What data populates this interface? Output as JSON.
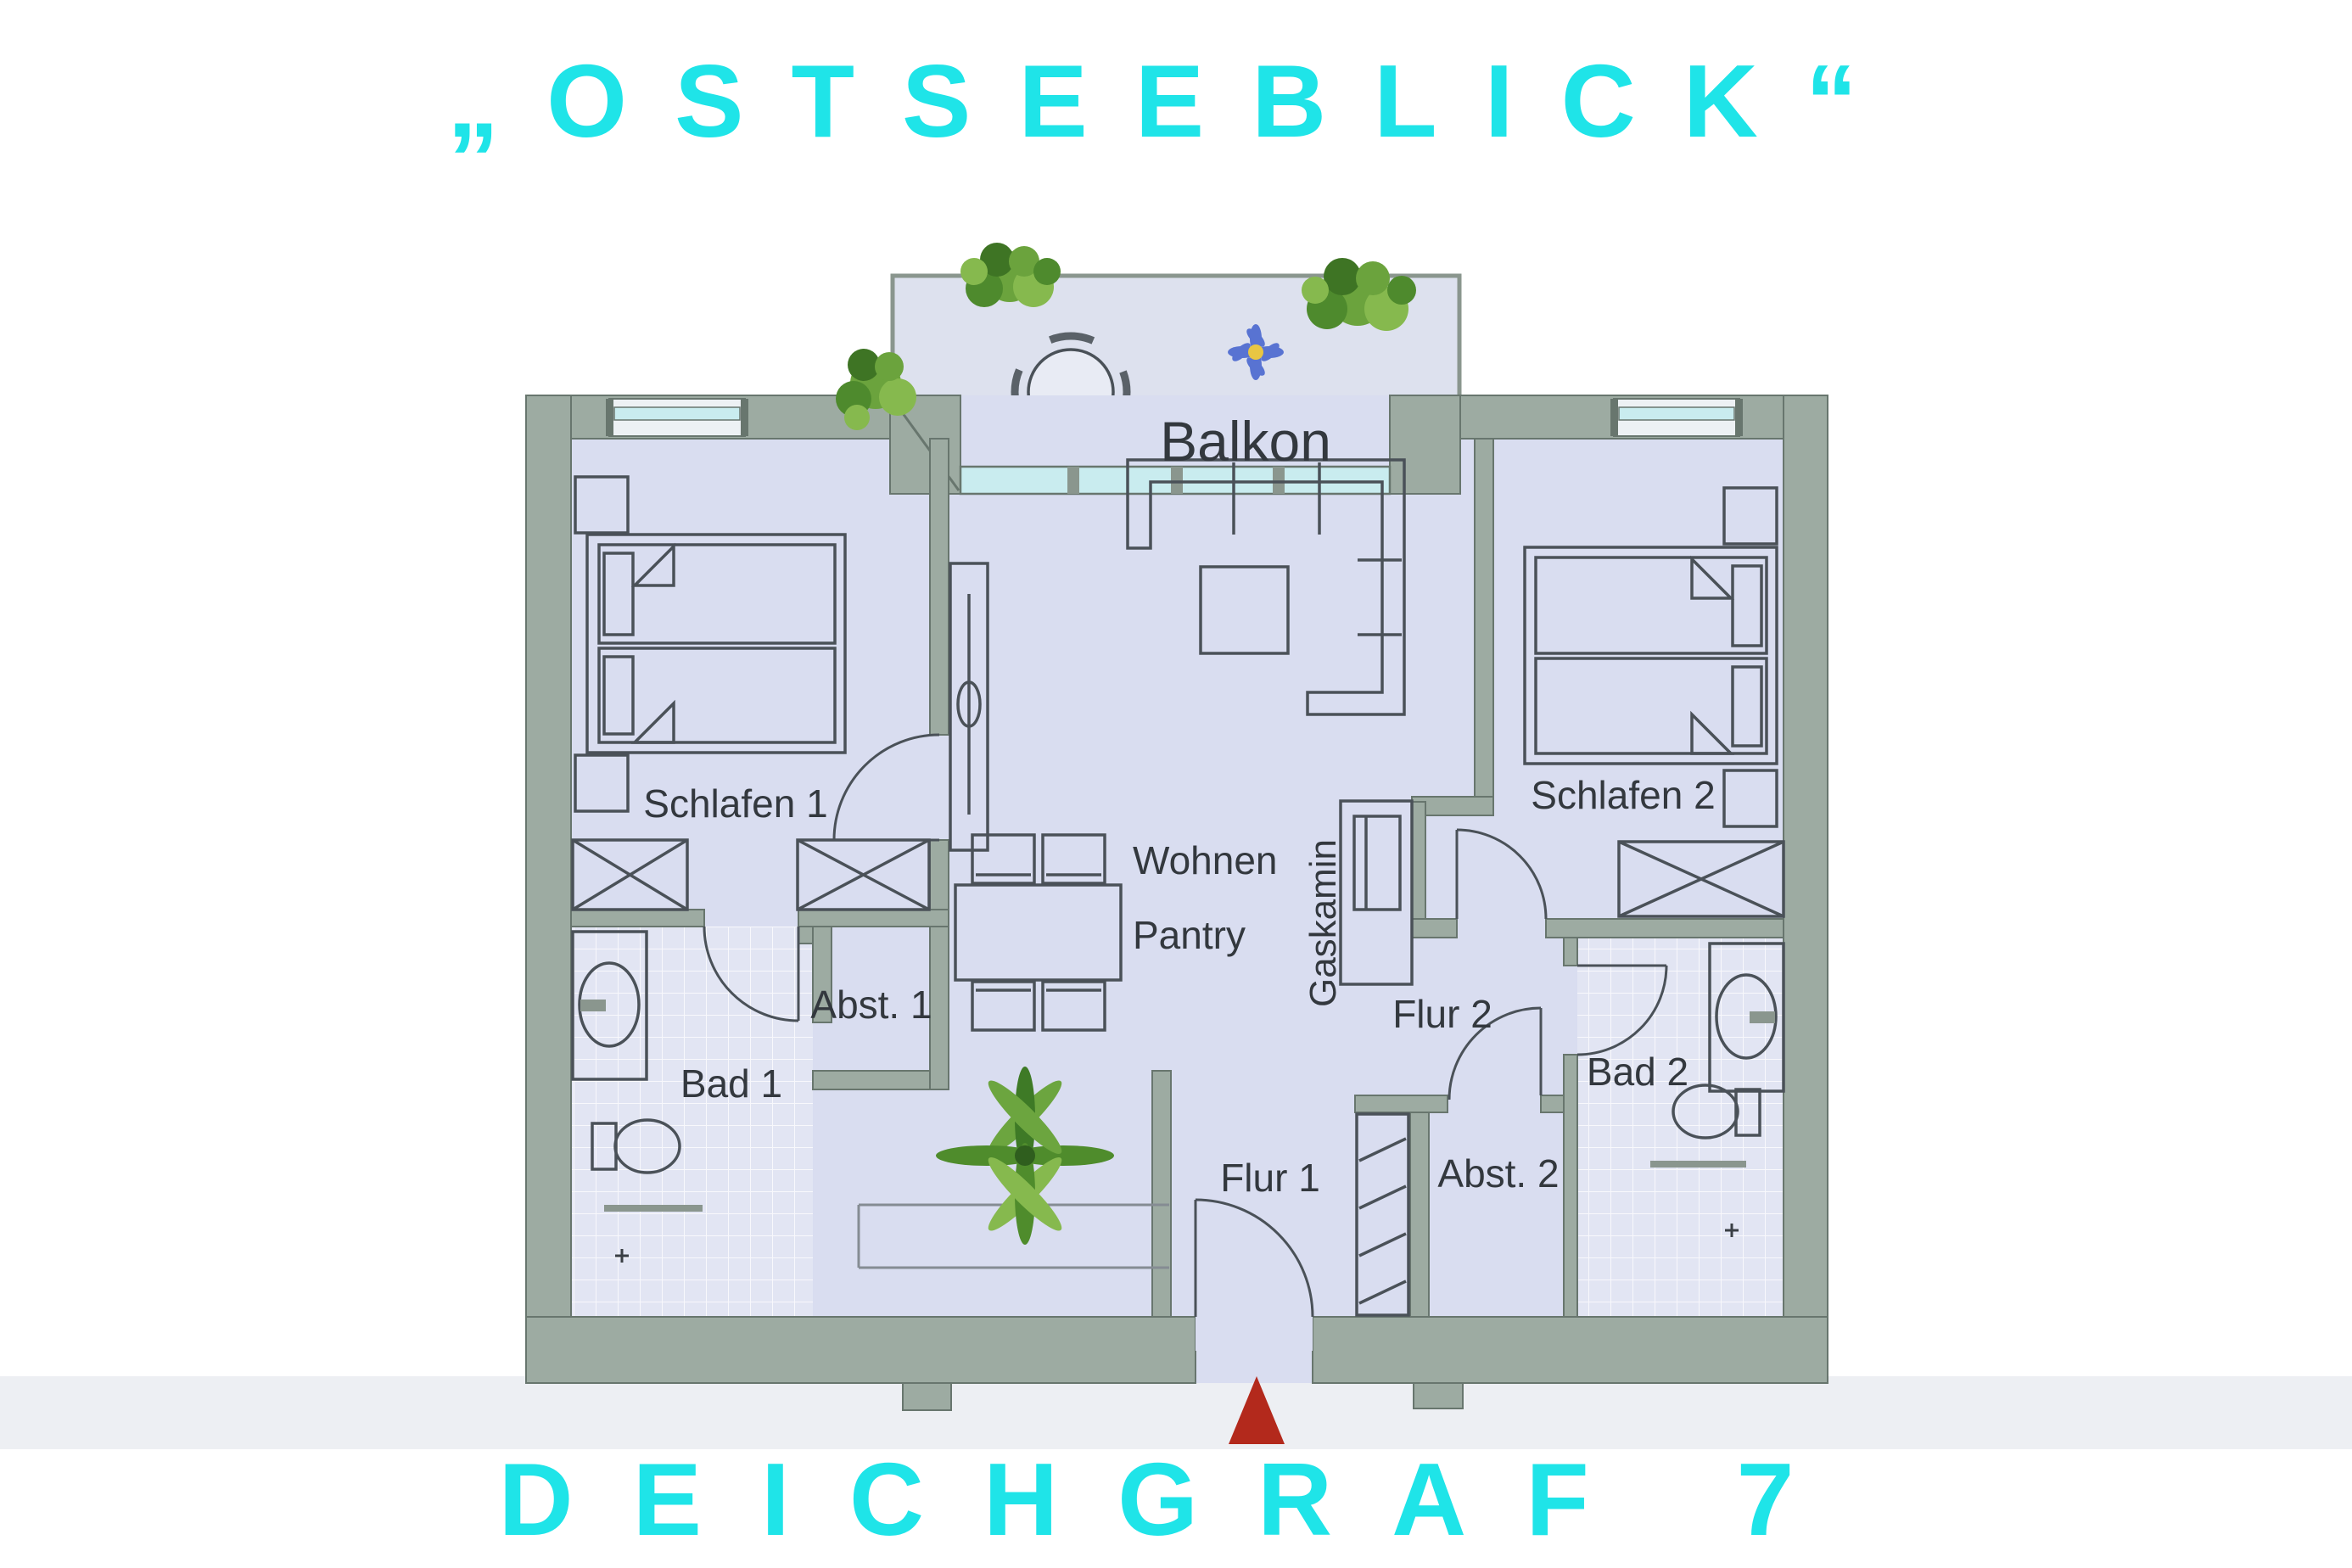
{
  "page": {
    "title_top": "„OSTSEEBLICK“",
    "title_bottom": "DEICHGRAF 7",
    "accent_color": "#1FE4E8"
  },
  "floorplan": {
    "labels": {
      "balcony": "Balkon",
      "bedroom1": "Schlafen 1",
      "bedroom2": "Schlafen 2",
      "living1": "Wohnen",
      "living2": "Pantry",
      "fireplace": "Gaskamin",
      "bath1": "Bad 1",
      "bath2": "Bad 2",
      "storage1": "Abst. 1",
      "storage2": "Abst. 2",
      "hall1": "Flur 1",
      "hall2": "Flur 2"
    },
    "colors": {
      "wall": "#9DABA2",
      "floor": "#D9DDF0",
      "balcony_floor": "#DDE1EE",
      "bath_tile": "#E2E5F3",
      "furniture_line": "#4A5158",
      "label_text": "#33383E",
      "window_glass": "#C9ECEF",
      "entrance_marker_red": "#B3291C",
      "plant_green": "#5E9638",
      "flower_blue": "#5873D2"
    },
    "markers": {
      "entrance": "red-triangle-arrow"
    }
  }
}
